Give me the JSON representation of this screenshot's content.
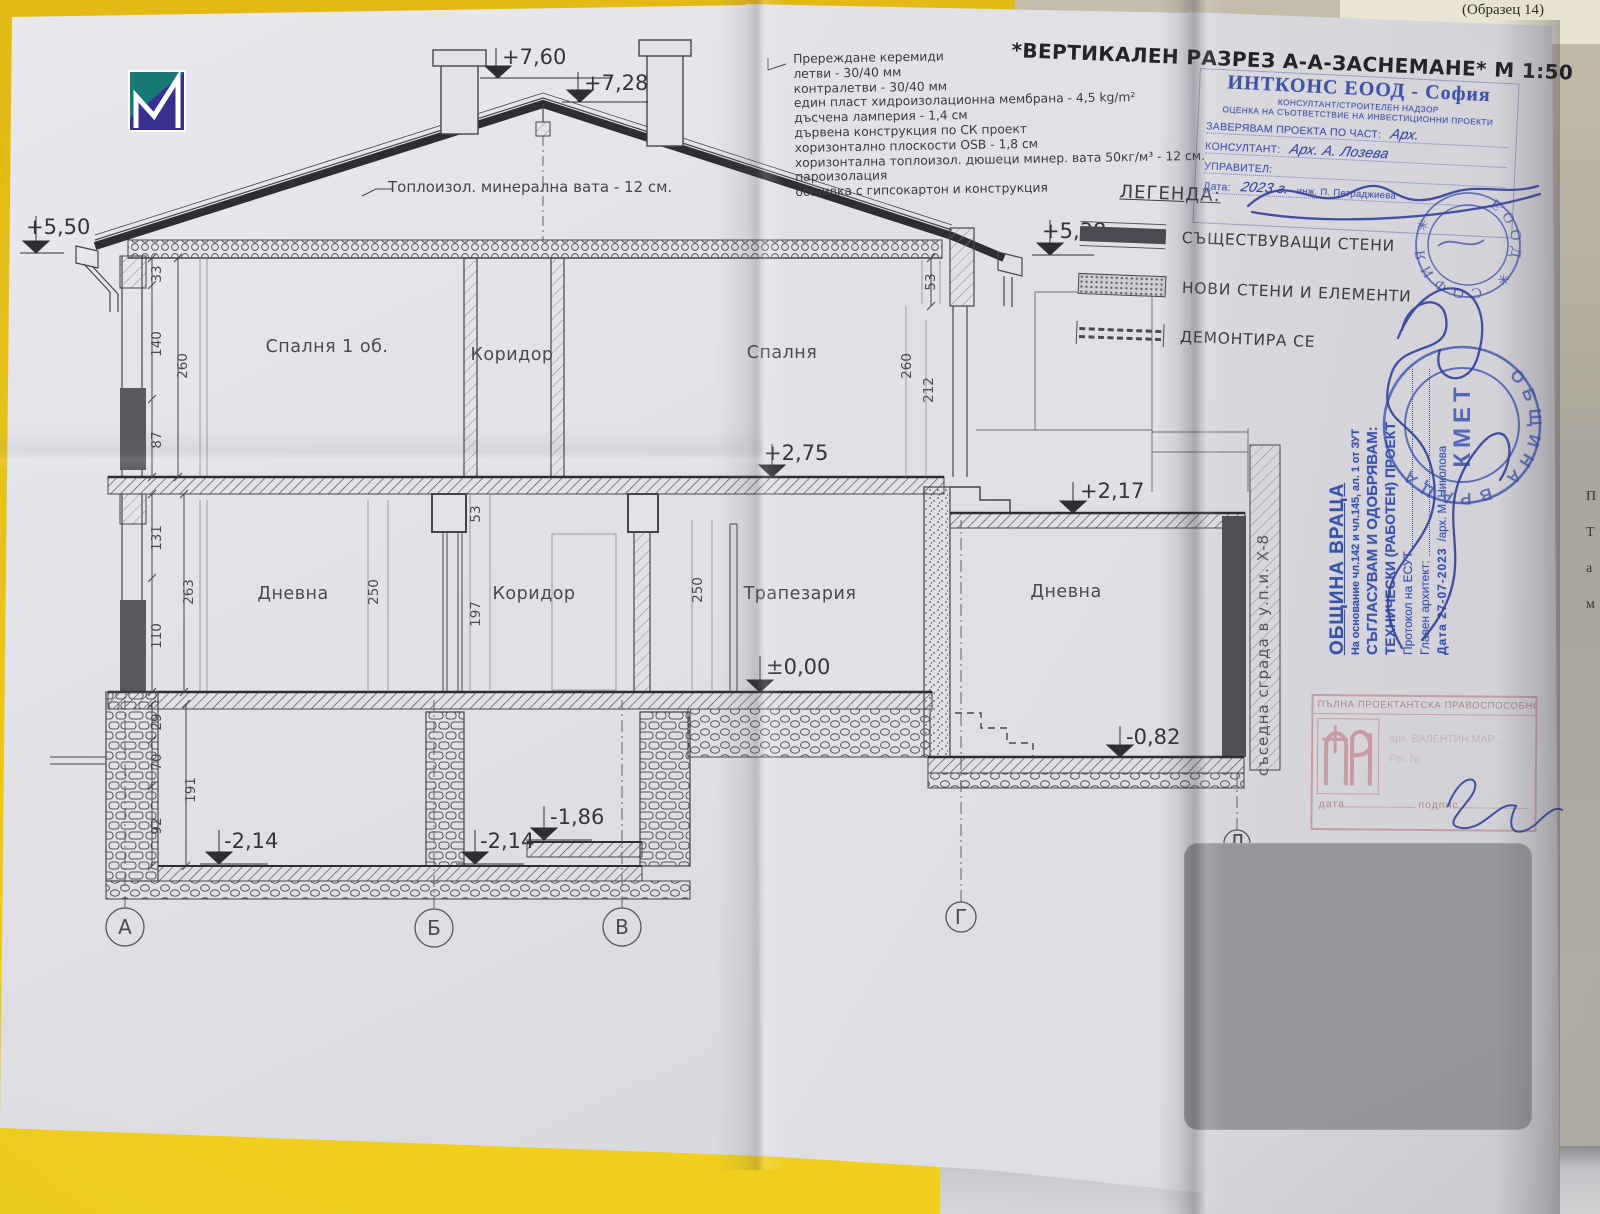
{
  "page": {
    "form_label": "(Образец 14)",
    "title": "*ВЕРТИКАЛЕН РАЗРЕЗ А-А-ЗАСНЕМАНЕ*  М 1:50"
  },
  "materials": {
    "lines": [
      "Пререждане керемиди",
      "летви - 30/40 мм",
      "контралетви - 30/40 мм",
      "един пласт хидроизолационна мембрана - 4,5 kg/m²",
      "дъсчена ламперия - 1,4 см",
      "дървена конструкция по СК проект",
      "хоризонтално плоскости OSB - 1,8 см",
      "хоризонтална топлоизол. дюшеци минер. вата 50кг/м³ - 12 см.",
      "пароизолация",
      "обшивка с гипсокартон и конструкция"
    ]
  },
  "roof_note": "Топлоизол. минерална вата - 12 см.",
  "legend": {
    "heading": "ЛЕГЕНДА:",
    "existing": "СЪЩЕСТВУВАЩИ СТЕНИ",
    "new": "НОВИ СТЕНИ И ЕЛЕМЕНТИ",
    "demolish": "ДЕМОНТИРА СЕ"
  },
  "rooms": {
    "bedroom1": "Спалня 1 об.",
    "corridor_upper": "Коридор",
    "bedroom2": "Спалня",
    "living_left": "Дневна",
    "corridor_ground": "Коридор",
    "dining": "Трапезария",
    "living_right": "Дневна"
  },
  "elevations": {
    "ridge": "+7,60",
    "ridge2": "+7,28",
    "eave_left": "+5,50",
    "eave_right": "+5,38",
    "floor1_ceiling": "+2,75",
    "terrace": "+2,17",
    "ground": "±0,00",
    "living_right_floor": "-0,82",
    "basement_right": "-1,86",
    "basement_left": "-2,14",
    "basement_mid": "-2,14"
  },
  "dims": {
    "d33": "33",
    "d140": "140",
    "d260L": "260",
    "d87": "87",
    "d131": "131",
    "d263": "263",
    "d110": "110",
    "d29": "29",
    "d70": "70",
    "d191": "191",
    "d92": "92",
    "d250a": "250",
    "d53a": "53",
    "d197": "197",
    "d250b": "250",
    "d53b": "53",
    "d260R": "260",
    "d212": "212"
  },
  "axes": {
    "a": "А",
    "b": "Б",
    "v": "В",
    "g": "Г",
    "d": "Д"
  },
  "side_note": "съседна сграда в у.п.и. X-8",
  "stamps": {
    "intcons": {
      "company": "ИНТКОНС ЕООД - София",
      "line1": "КОНСУЛТАНТ/СТРОИТЕЛЕН НАДЗОР",
      "line2": "ОЦЕНКА НА СЪОТВЕТСТВИЕ НА ИНВЕСТИЦИОННИ ПРОЕКТИ",
      "certify_label": "ЗАВЕРЯВАМ ПРОЕКТА ПО ЧАСТ:",
      "certify_value": "Арх.",
      "consultant_label": "КОНСУЛТАНТ:",
      "consultant_value": "Арх. А. Лозева",
      "manager_label": "УПРАВИТЕЛ:",
      "date_label": "Дата:",
      "date_value": "2023 г.",
      "engineer": "инж. П. Петраджиева",
      "seal_text": "ЕООД ✳ СОФИЯ ✳"
    },
    "vratsa": {
      "municipality": "ОБЩИНА ВРАЦА",
      "legal": "На основание чл.142 и чл.145, ал. 1 от ЗУТ",
      "approve1": "СЪГЛАСУВАМ И ОДОБРЯВАМ:",
      "approve2": "ТЕХНИЧЕСКИ (РАБОТЕН) ПРОЕКТ",
      "protocol": "Протокол на ЕСУТ",
      "chief_architect": "Главен архитект:",
      "date": "Дата 27-07-2023",
      "architect": "/арх. М. Николова",
      "seal_center": "КМЕТ",
      "seal_ring": "ОБЩИНА ВРАЦА"
    },
    "kab": {
      "heading": "ПЪЛНА ПРОЕКТАНТСКА ПРАВОСПОСОБНОСТ",
      "name": "арх. ВАЛЕНТИН МАР…",
      "reg": "Рег. №",
      "date_label": "дата",
      "sign_label": "подпис"
    }
  },
  "edge_letters": {
    "l1": "П",
    "l2": "Т",
    "l3": "а",
    "l4": "м"
  }
}
